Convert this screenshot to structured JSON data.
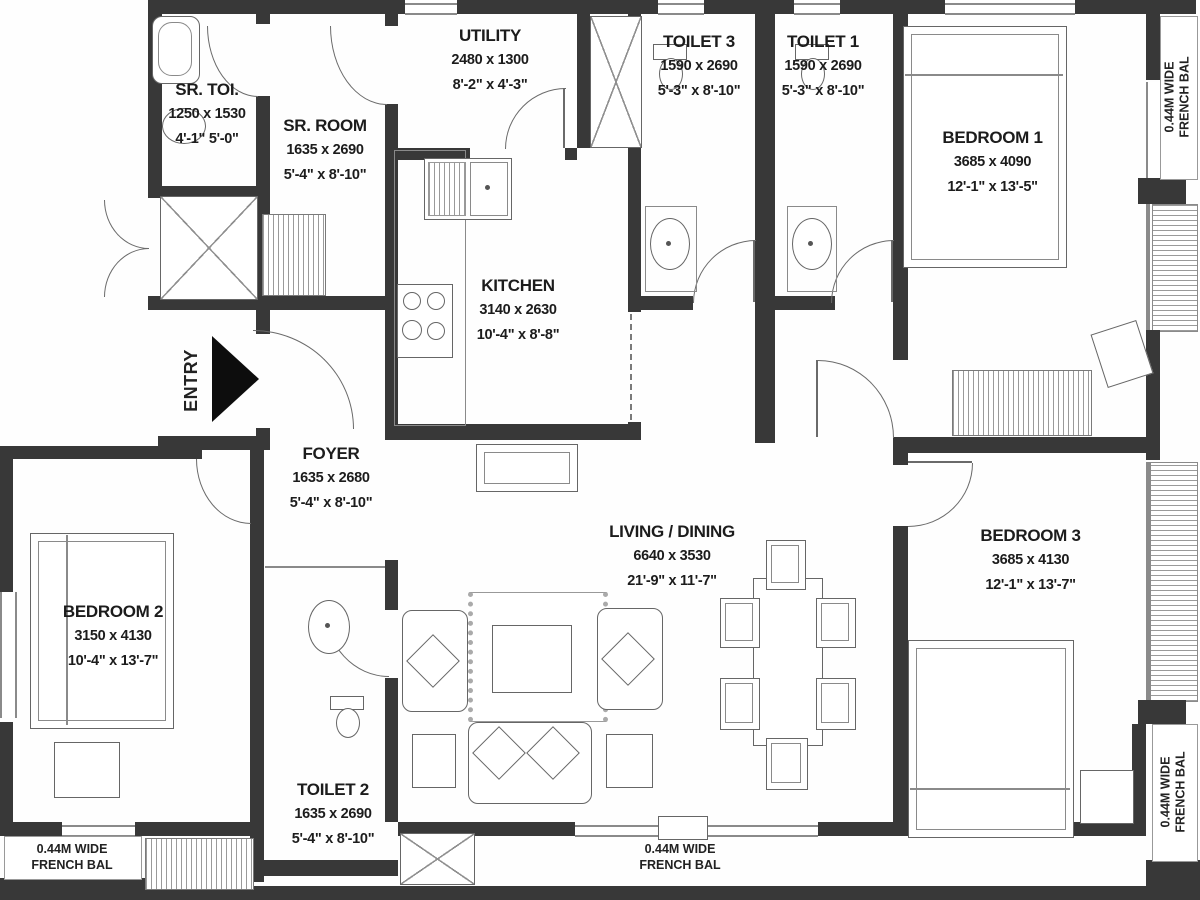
{
  "title": "3 BHK Apartment Floor Plan",
  "rooms": [
    {
      "id": "sr-toi",
      "name": "SR. TOI.",
      "dim_mm": "1250 x 1530",
      "dim_ft": "4'-1\"  5'-0\""
    },
    {
      "id": "sr-room",
      "name": "SR. ROOM",
      "dim_mm": "1635 x 2690",
      "dim_ft": "5'-4\" x 8'-10\""
    },
    {
      "id": "utility",
      "name": "UTILITY",
      "dim_mm": "2480 x 1300",
      "dim_ft": "8'-2\" x 4'-3\""
    },
    {
      "id": "toilet-3",
      "name": "TOILET 3",
      "dim_mm": "1590 x 2690",
      "dim_ft": "5'-3\" x 8'-10\""
    },
    {
      "id": "toilet-1",
      "name": "TOILET 1",
      "dim_mm": "1590 x 2690",
      "dim_ft": "5'-3\" x 8'-10\""
    },
    {
      "id": "bedroom-1",
      "name": "BEDROOM 1",
      "dim_mm": "3685 x 4090",
      "dim_ft": "12'-1\" x 13'-5\""
    },
    {
      "id": "kitchen",
      "name": "KITCHEN",
      "dim_mm": "3140 x 2630",
      "dim_ft": "10'-4\" x 8'-8\""
    },
    {
      "id": "foyer",
      "name": "FOYER",
      "dim_mm": "1635 x 2680",
      "dim_ft": "5'-4\" x 8'-10\""
    },
    {
      "id": "living",
      "name": "LIVING / DINING",
      "dim_mm": "6640 x 3530",
      "dim_ft": "21'-9\" x 11'-7\""
    },
    {
      "id": "bedroom-2",
      "name": "BEDROOM 2",
      "dim_mm": "3150 x 4130",
      "dim_ft": "10'-4\" x 13'-7\""
    },
    {
      "id": "toilet-2",
      "name": "TOILET 2",
      "dim_mm": "1635 x 2690",
      "dim_ft": "5'-4\" x 8'-10\""
    },
    {
      "id": "bedroom-3",
      "name": "BEDROOM 3",
      "dim_mm": "3685 x 4130",
      "dim_ft": "12'-1\" x 13'-7\""
    }
  ],
  "annotations": {
    "entry": "ENTRY",
    "balcony": {
      "line1": "0.44M WIDE",
      "line2": "FRENCH BAL"
    }
  },
  "colors": {
    "wall": "#383838",
    "line": "#666666",
    "text": "#1c1c1c",
    "background": "#fefefe"
  }
}
